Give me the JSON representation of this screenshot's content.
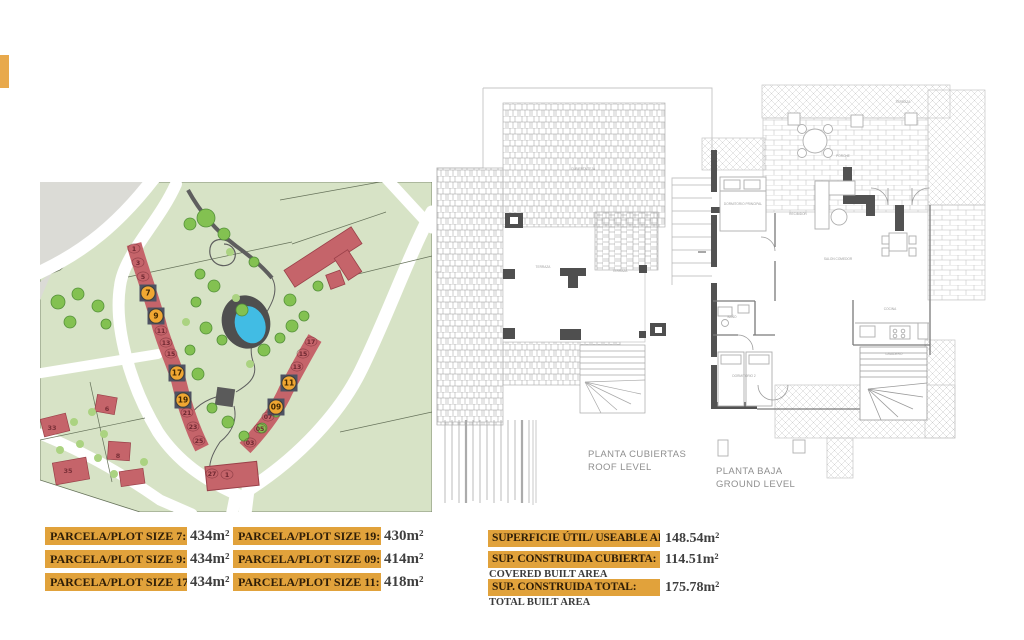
{
  "edge_marker": {
    "color": "#E8A94C"
  },
  "watermark": {
    "text": "www"
  },
  "site_map": {
    "colors": {
      "green": "#D7E3C6",
      "gray": "#DBDBD6",
      "plot_red": "#C5646A",
      "plot_red_stroke": "#9A4049",
      "highlight_square": "#4E5263",
      "highlight_circle": "#F0A732",
      "pond_blue": "#41BCE4",
      "tree_green": "#83C151",
      "path_dark": "#5E5E5E"
    },
    "left_arc": [
      {
        "n": "1",
        "x": 94,
        "y": 68
      },
      {
        "n": "3",
        "x": 98,
        "y": 82
      },
      {
        "n": "5",
        "x": 103,
        "y": 96
      },
      {
        "n": "7",
        "x": 108,
        "y": 111,
        "hl": true
      },
      {
        "n": "9",
        "x": 116,
        "y": 134,
        "hl": true
      },
      {
        "n": "11",
        "x": 121,
        "y": 150
      },
      {
        "n": "13",
        "x": 126,
        "y": 162
      },
      {
        "n": "15",
        "x": 131,
        "y": 173
      },
      {
        "n": "17",
        "x": 137,
        "y": 191,
        "hl": true
      },
      {
        "n": "19",
        "x": 143,
        "y": 218,
        "hl": true
      },
      {
        "n": "21",
        "x": 147,
        "y": 232
      },
      {
        "n": "23",
        "x": 153,
        "y": 246
      },
      {
        "n": "25",
        "x": 159,
        "y": 260
      }
    ],
    "right_arc": [
      {
        "n": "17",
        "x": 271,
        "y": 161
      },
      {
        "n": "15",
        "x": 263,
        "y": 173
      },
      {
        "n": "13",
        "x": 257,
        "y": 186
      },
      {
        "n": "11",
        "x": 249,
        "y": 201,
        "hl": true
      },
      {
        "n": "09",
        "x": 236,
        "y": 225,
        "hl": true
      },
      {
        "n": "07",
        "x": 228,
        "y": 236
      },
      {
        "n": "05",
        "x": 220,
        "y": 248
      },
      {
        "n": "03",
        "x": 210,
        "y": 262
      }
    ],
    "corner_plot_numbers": [
      {
        "n": "27",
        "x": 172,
        "y": 293
      },
      {
        "n": "1",
        "x": 187,
        "y": 294
      }
    ],
    "side_plots": [
      {
        "n": "33",
        "x": 12,
        "y": 246
      },
      {
        "n": "35",
        "x": 28,
        "y": 289
      },
      {
        "n": "6",
        "x": 67,
        "y": 227
      },
      {
        "n": "8",
        "x": 78,
        "y": 274
      }
    ]
  },
  "roof_plan": {
    "title_line1": "PLANTA CUBIERTAS",
    "title_line2": "ROOF LEVEL",
    "room_labels": [
      {
        "t": "CUBIERTA TEJA",
        "x": 148,
        "y": 150
      },
      {
        "t": "TERRAZA",
        "x": 108,
        "y": 248
      },
      {
        "t": "TERRAZA",
        "x": 185,
        "y": 252
      }
    ]
  },
  "ground_plan": {
    "title_line1": "PLANTA BAJA",
    "title_line2": "GROUND LEVEL",
    "room_labels": [
      {
        "t": "DORMITORIO PRINCIPAL",
        "x": 45,
        "y": 150
      },
      {
        "t": "RECIBIDOR",
        "x": 100,
        "y": 160
      },
      {
        "t": "SALON COMEDOR",
        "x": 140,
        "y": 205
      },
      {
        "t": "COCINA",
        "x": 192,
        "y": 255
      },
      {
        "t": "BAÑO",
        "x": 34,
        "y": 263
      },
      {
        "t": "DORMITORIO 2",
        "x": 46,
        "y": 322
      },
      {
        "t": "PORCHE",
        "x": 145,
        "y": 102
      },
      {
        "t": "TERRAZA",
        "x": 205,
        "y": 48
      },
      {
        "t": "LAVADERO",
        "x": 196,
        "y": 300
      }
    ]
  },
  "plot_size_labels": [
    {
      "label": "PARCELA/PLOT SIZE 7:",
      "value": "434m²"
    },
    {
      "label": "PARCELA/PLOT SIZE 9:",
      "value": "434m²"
    },
    {
      "label": "PARCELA/PLOT SIZE 17:",
      "value": "434m²"
    },
    {
      "label": "PARCELA/PLOT SIZE 19:",
      "value": "430m²"
    },
    {
      "label": "PARCELA/PLOT SIZE 09:",
      "value": "414m²"
    },
    {
      "label": "PARCELA/PLOT SIZE 11:",
      "value": "418m²"
    }
  ],
  "area_labels": [
    {
      "label": "SUPERFICIE ÚTIL/ USEABLE AREA:",
      "value": "148.54m²",
      "sub": ""
    },
    {
      "label": "SUP. CONSTRUIDA CUBIERTA:",
      "value": "114.51m²",
      "sub": "COVERED BUILT AREA"
    },
    {
      "label": "SUP. CONSTRUIDA TOTAL:",
      "value": "175.78m²",
      "sub": "TOTAL BUILT AREA"
    }
  ]
}
